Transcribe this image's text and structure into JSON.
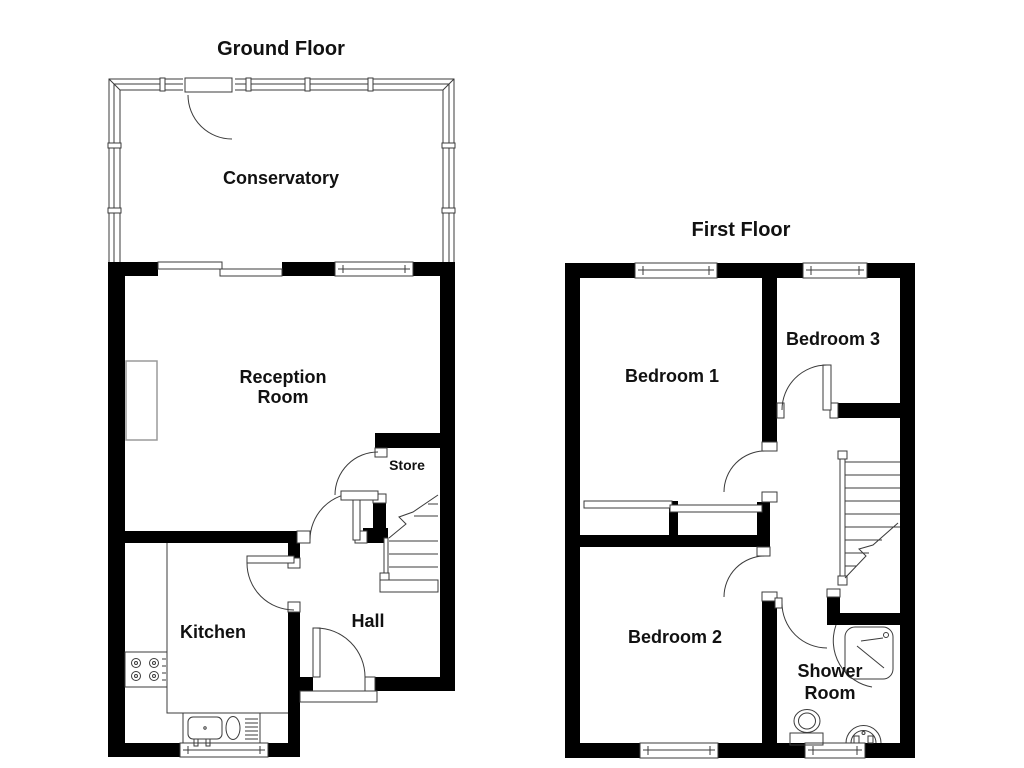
{
  "figure": {
    "type": "floorplan",
    "floors_shown": 2
  },
  "colors": {
    "wall": "#000000",
    "line": "#3b3b3b",
    "muted": "#9a9a9a",
    "text": "#111111",
    "background": "#ffffff"
  },
  "ground_floor": {
    "title": "Ground Floor",
    "rooms": {
      "conservatory": "Conservatory",
      "reception_line1": "Reception",
      "reception_line2": "Room",
      "store": "Store",
      "kitchen": "Kitchen",
      "hall": "Hall"
    },
    "fixtures": [
      "glazed-conservatory-walls",
      "patio-sliding-doors",
      "chimney-breast",
      "hob-4-burner",
      "sink-with-drainer",
      "worktop",
      "staircase-up",
      "front-door",
      "under-stairs-store"
    ]
  },
  "first_floor": {
    "title": "First Floor",
    "rooms": {
      "bedroom1": "Bedroom 1",
      "bedroom3": "Bedroom 3",
      "bedroom2": "Bedroom 2",
      "shower_line1": "Shower",
      "shower_line2": "Room"
    },
    "fixtures": [
      "built-in-cupboards",
      "staircase",
      "corner-shower",
      "toilet",
      "wash-basin",
      "windows"
    ]
  }
}
